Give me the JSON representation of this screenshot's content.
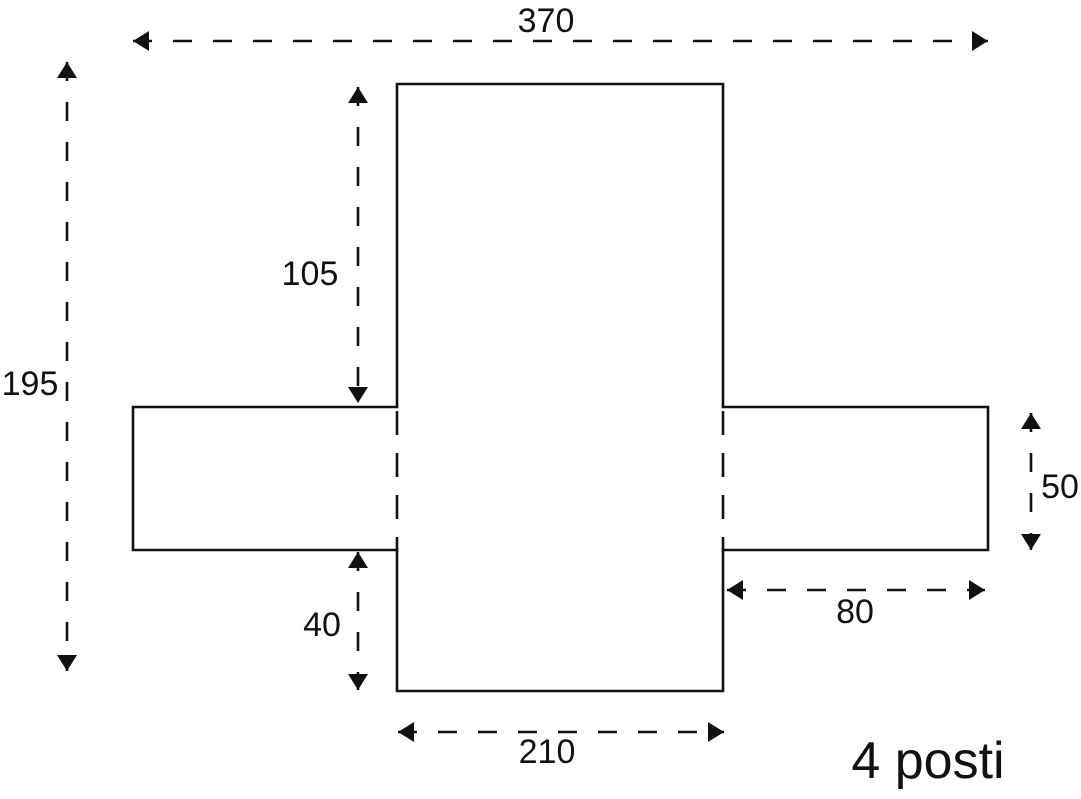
{
  "diagram": {
    "caption": "4 posti",
    "colors": {
      "background": "#ffffff",
      "line": "#111111"
    },
    "dimensions": {
      "total_width": {
        "label": "370",
        "value": 370,
        "orientation": "horizontal"
      },
      "total_height": {
        "label": "195",
        "value": 195,
        "orientation": "vertical"
      },
      "upper_drop": {
        "label": "105",
        "value": 105,
        "orientation": "vertical"
      },
      "lower_drop": {
        "label": "40",
        "value": 40,
        "orientation": "vertical"
      },
      "side_flap_height": {
        "label": "50",
        "value": 50,
        "orientation": "vertical"
      },
      "side_flap_width": {
        "label": "80",
        "value": 80,
        "orientation": "horizontal"
      },
      "seat_width": {
        "label": "210",
        "value": 210,
        "orientation": "horizontal"
      }
    }
  }
}
